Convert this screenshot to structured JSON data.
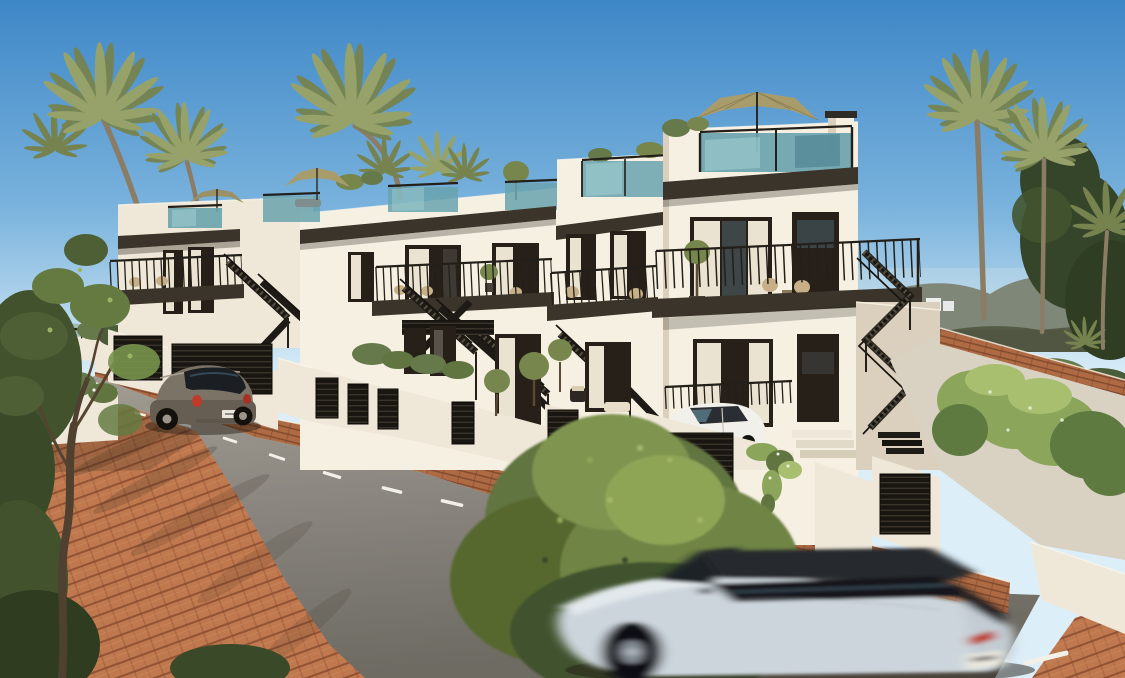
{
  "meta": {
    "width": 1125,
    "height": 678,
    "type": "architectural-render",
    "subject": "modern-townhouse-street-scene"
  },
  "scene": {
    "sky": "clear-blue-sky",
    "background": [
      "distant-hills",
      "palm-trees",
      "dark-tree",
      "shrub-band",
      "distant-white-houses"
    ],
    "buildings": [
      "townhouse-1",
      "townhouse-2",
      "townhouse-3",
      "townhouse-4-tall"
    ],
    "features": [
      "rooftop-terrace",
      "glass-balustrade",
      "patio-umbrella",
      "black-exterior-staircase",
      "balcony-railing",
      "louvered-garage-door",
      "garden-wall",
      "hedge",
      "planter-tree",
      "hanging-vine",
      "chimney",
      "wicker-chairs"
    ],
    "street": [
      "asphalt-road",
      "dashed-center-line",
      "brick-sidewalk",
      "brick-curb",
      "sloped-boundary-wall"
    ],
    "vehicles": [
      "parked-beetle",
      "parked-city-car",
      "moving-suv"
    ]
  },
  "colors": {
    "sky_top": "#3e87c7",
    "sky_mid": "#7ab3dd",
    "sky_low": "#dceef8",
    "hill": "#5c614a",
    "hill_haze": "#9fb2ae",
    "shrub_dark": "#4a5c38",
    "shrub_mid": "#66794a",
    "tree_dark": "#35452a",
    "palm_green": "#96a26a",
    "palm_green_dark": "#76834f",
    "palm_trunk": "#8b7c65",
    "facade": "#efe7d7",
    "facade_bright": "#f6f0e3",
    "facade_shade": "#dbd0bd",
    "fascia": "#3a342a",
    "frame": "#262019",
    "glass": "#6aa3ae",
    "glass_hi": "#a8d4d8",
    "rail": "#231f19",
    "umbrella": "#a99c6b",
    "curtain": "#ebe3d2",
    "wicker": "#c7b087",
    "olive_tree": "#77864d",
    "hedge": "#8ba65b",
    "hedge_hi": "#a9bf70",
    "hedge_sh": "#5f7a41",
    "bush_dark": "#41522d",
    "bush_mid": "#617540",
    "bush_hi": "#8fa557",
    "trunk": "#54432f",
    "wall": "#efe8d9",
    "ramp": "#d9d2c3",
    "road_hi": "#a29d92",
    "road": "#8b8780",
    "road_lo": "#6e6b63",
    "brick": "#c0794f",
    "brick_dark": "#8a4c30",
    "brick_mid": "#ad6a43",
    "brick_joint": "#7c462a",
    "dash": "#f2f0e8",
    "louver": "#191611",
    "louver_hi": "#4c453a",
    "beetle": "#7c7367",
    "beetle_lo": "#665e52",
    "glass_dark": "#1b1e22",
    "red_light": "#bf3a28",
    "plate": "#eae8de",
    "suv": "#ccd5db",
    "suv_hi": "#e2e8ec",
    "suv_dark": "#27292d",
    "citycar": "#f2f0ea",
    "shadow": "#241d14"
  }
}
